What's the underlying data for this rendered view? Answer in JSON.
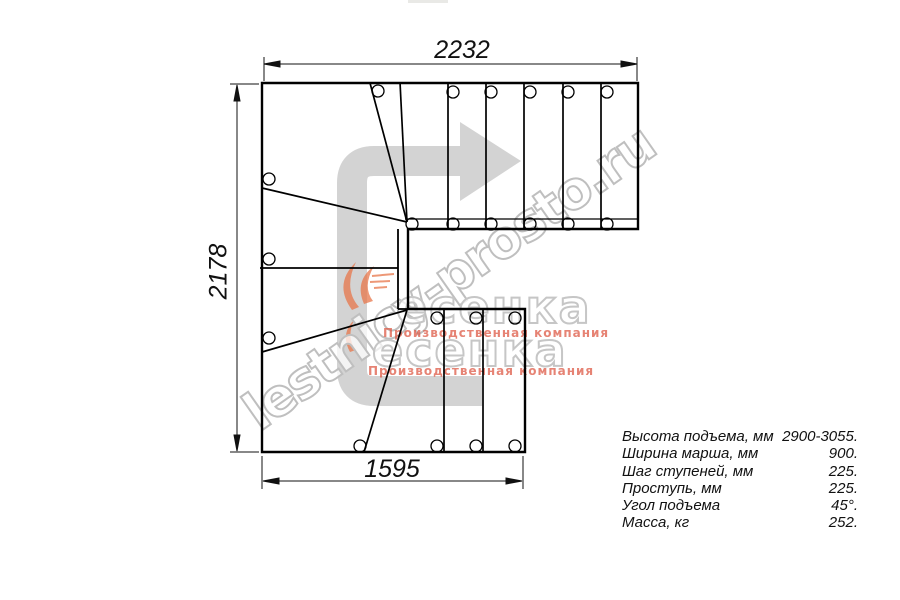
{
  "drawing_title": "L/U-turn staircase plan (top view)",
  "dimensions": {
    "top_width_mm": "2232",
    "left_height_mm": "2178",
    "bottom_width_mm": "1595"
  },
  "specs": {
    "rows": [
      {
        "label": "Высота подъема, мм",
        "value": "2900-3055."
      },
      {
        "label": "Ширина марша, мм",
        "value": "900."
      },
      {
        "label": "Шаг ступеней, мм",
        "value": "225."
      },
      {
        "label": "Проступь, мм",
        "value": "225."
      },
      {
        "label": "Угол подъема",
        "value": "45°."
      },
      {
        "label": "Масса, кг",
        "value": "252."
      }
    ]
  },
  "watermark": {
    "site_text": "lestnicy-prosto.ru",
    "logo_text": "есенка",
    "logo_caption": "Производственная компания"
  },
  "colors": {
    "line": "#000000",
    "dimension": "#111111",
    "watermark_gray": "#bfbfbf",
    "watermark_red": "#dd5a46",
    "arrow_gray": "#d3d3d3",
    "swoosh_orange": "#e8764a"
  }
}
